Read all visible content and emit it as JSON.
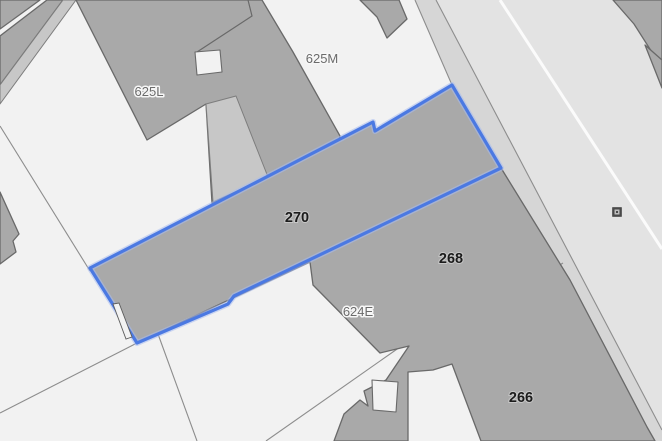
{
  "map": {
    "selection": {
      "selected_building_label": "270",
      "outline_color": "#4b79e2"
    },
    "parcel_labels": [
      {
        "text": "625L",
        "x": 149,
        "y": 96
      },
      {
        "text": "625M",
        "x": 322,
        "y": 63
      },
      {
        "text": "624E",
        "x": 358,
        "y": 316
      }
    ],
    "building_labels": [
      {
        "text": "270",
        "x": 297,
        "y": 222
      },
      {
        "text": "268",
        "x": 451,
        "y": 263
      },
      {
        "text": "266",
        "x": 521,
        "y": 402
      }
    ],
    "markers": [
      {
        "name": "utility-marker",
        "x": 617,
        "y": 212
      }
    ],
    "colors": {
      "background_parcels": "#f2f2f2",
      "building_fill": "#a9a9a9",
      "building_outline": "#696969",
      "light_parcel_strip": "#c7c7c7",
      "road_fill": "#e3e3e3",
      "sidewalk_fill": "#d6d6d6",
      "road_centerline": "#fbfbfb",
      "parcel_line": "#8d8d8d",
      "selection_outline": "#4b79e2",
      "parcel_label_color": "#6b6b6b",
      "building_label_color": "#1c1c1c"
    }
  }
}
